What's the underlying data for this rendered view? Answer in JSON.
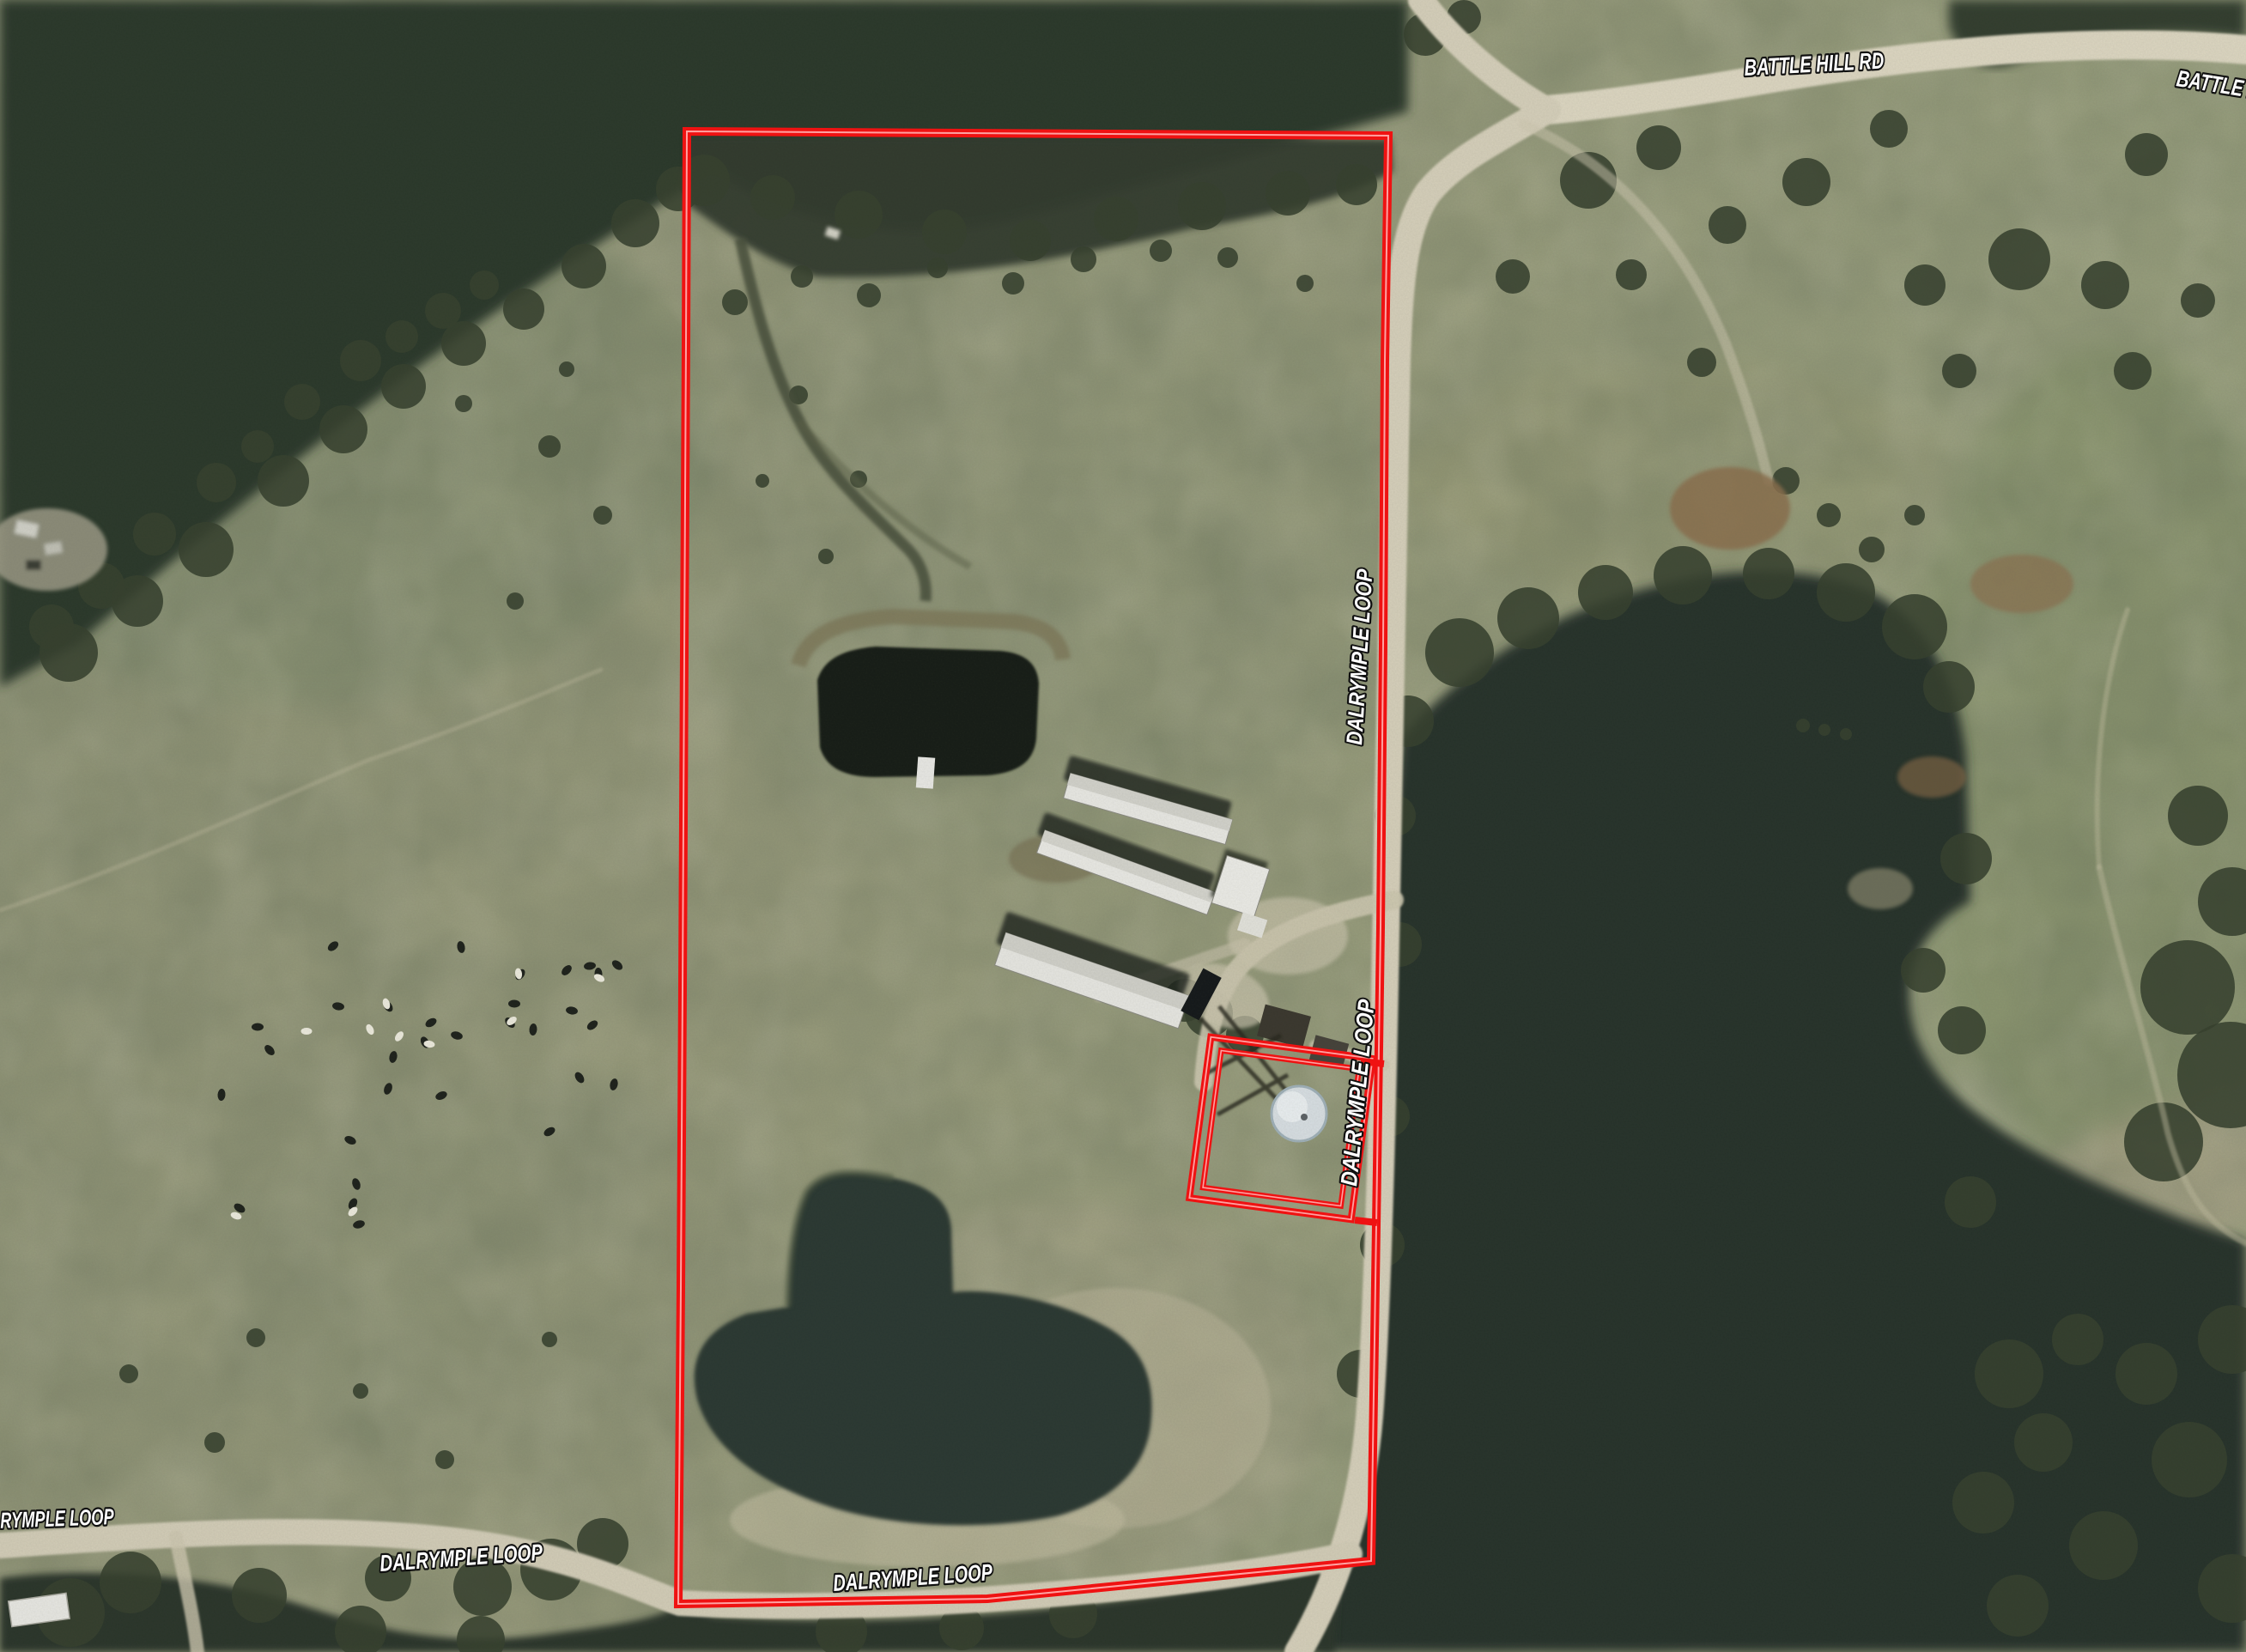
{
  "map": {
    "boundary": {
      "color": "#ef1212",
      "inner_line_color": "#ffa2a2"
    },
    "label_style": {
      "fill": "#ffffff",
      "outline": "#101010"
    },
    "palette": {
      "tree": "#35402e",
      "cattle_dark": "#1d211b",
      "cattle_light": "#ebe9dc"
    },
    "road_labels": {
      "battle_hill_top": "BATTLE HILL RD",
      "battle_hill_right_clipped": "BATTLE HILL RD",
      "dalrymple_east_upper": "DALRYMPLE LOOP",
      "dalrymple_east_lower": "DALRYMPLE LOOP",
      "dalrymple_south_far_left_clipped": "DALRYMPLE LOOP",
      "dalrymple_south_west": "DALRYMPLE LOOP",
      "dalrymple_south_center": "DALRYMPLE LOOP"
    },
    "trees": [
      [
        420,
        420,
        24
      ],
      [
        468,
        392,
        19
      ],
      [
        516,
        362,
        21
      ],
      [
        564,
        332,
        17
      ],
      [
        352,
        468,
        21
      ],
      [
        300,
        520,
        19
      ],
      [
        252,
        562,
        23
      ],
      [
        180,
        622,
        25
      ],
      [
        118,
        682,
        27
      ],
      [
        60,
        730,
        26
      ],
      [
        640,
        520,
        13
      ],
      [
        702,
        600,
        11
      ],
      [
        600,
        700,
        10
      ],
      [
        540,
        470,
        10
      ],
      [
        660,
        430,
        9
      ],
      [
        298,
        1558,
        11
      ],
      [
        420,
        1620,
        9
      ],
      [
        518,
        1700,
        11
      ],
      [
        250,
        1680,
        12
      ],
      [
        150,
        1600,
        11
      ],
      [
        640,
        1560,
        9
      ],
      [
        856,
        352,
        15
      ],
      [
        934,
        322,
        13
      ],
      [
        1012,
        344,
        14
      ],
      [
        1092,
        312,
        12
      ],
      [
        1180,
        330,
        13
      ],
      [
        1262,
        302,
        15
      ],
      [
        1352,
        292,
        13
      ],
      [
        930,
        460,
        11
      ],
      [
        1000,
        558,
        10
      ],
      [
        962,
        648,
        9
      ],
      [
        888,
        560,
        8
      ],
      [
        1430,
        300,
        12
      ],
      [
        1520,
        330,
        10
      ],
      [
        820,
        210,
        30
      ],
      [
        900,
        230,
        26
      ],
      [
        1000,
        250,
        28
      ],
      [
        1100,
        270,
        26
      ],
      [
        1200,
        280,
        24
      ],
      [
        1300,
        255,
        26
      ],
      [
        1400,
        240,
        28
      ],
      [
        1500,
        225,
        26
      ],
      [
        1580,
        215,
        24
      ],
      [
        80,
        760,
        34
      ],
      [
        160,
        700,
        30
      ],
      [
        240,
        640,
        32
      ],
      [
        330,
        560,
        30
      ],
      [
        400,
        500,
        28
      ],
      [
        470,
        450,
        26
      ],
      [
        540,
        400,
        26
      ],
      [
        610,
        360,
        24
      ],
      [
        680,
        310,
        26
      ],
      [
        740,
        260,
        28
      ],
      [
        790,
        220,
        26
      ],
      [
        1850,
        210,
        33
      ],
      [
        1932,
        172,
        26
      ],
      [
        2012,
        262,
        22
      ],
      [
        1762,
        322,
        20
      ],
      [
        2104,
        212,
        28
      ],
      [
        2242,
        332,
        24
      ],
      [
        2352,
        302,
        36
      ],
      [
        2282,
        432,
        20
      ],
      [
        1982,
        422,
        17
      ],
      [
        2452,
        332,
        28
      ],
      [
        2484,
        432,
        22
      ],
      [
        2560,
        350,
        20
      ],
      [
        2200,
        150,
        22
      ],
      [
        1900,
        320,
        18
      ],
      [
        2500,
        180,
        25
      ],
      [
        2100,
        845,
        8
      ],
      [
        2125,
        850,
        7
      ],
      [
        2150,
        855,
        7
      ],
      [
        2080,
        560,
        16
      ],
      [
        2130,
        600,
        14
      ],
      [
        2180,
        640,
        15
      ],
      [
        2230,
        600,
        12
      ],
      [
        2548,
        1150,
        55
      ],
      [
        2598,
        1252,
        62
      ],
      [
        2520,
        1330,
        46
      ],
      [
        2600,
        1050,
        40
      ],
      [
        2560,
        950,
        35
      ],
      [
        642,
        1828,
        36
      ],
      [
        702,
        1798,
        30
      ],
      [
        562,
        1848,
        34
      ],
      [
        452,
        1838,
        27
      ],
      [
        302,
        1858,
        32
      ],
      [
        152,
        1843,
        36
      ],
      [
        82,
        1878,
        40
      ],
      [
        980,
        1900,
        30
      ],
      [
        1120,
        1896,
        26
      ],
      [
        1250,
        1880,
        28
      ],
      [
        420,
        1900,
        30
      ],
      [
        560,
        1910,
        28
      ],
      [
        1660,
        40,
        25
      ],
      [
        1705,
        20,
        20
      ],
      [
        1700,
        760,
        40
      ],
      [
        1780,
        720,
        36
      ],
      [
        1870,
        690,
        32
      ],
      [
        1960,
        670,
        34
      ],
      [
        2060,
        668,
        30
      ],
      [
        2150,
        690,
        34
      ],
      [
        2230,
        730,
        38
      ],
      [
        2270,
        800,
        30
      ],
      [
        1640,
        840,
        30
      ],
      [
        1625,
        950,
        24
      ],
      [
        1630,
        1100,
        26
      ],
      [
        1618,
        1300,
        24
      ],
      [
        1610,
        1450,
        26
      ],
      [
        1585,
        1600,
        28
      ],
      [
        2290,
        1000,
        30
      ],
      [
        2285,
        1200,
        28
      ],
      [
        2240,
        1130,
        26
      ],
      [
        2295,
        1400,
        30
      ],
      [
        2340,
        1600,
        40
      ],
      [
        2310,
        1750,
        36
      ],
      [
        2420,
        1560,
        30
      ],
      [
        2380,
        1680,
        34
      ],
      [
        2500,
        1600,
        36
      ],
      [
        2600,
        1560,
        40
      ],
      [
        2550,
        1700,
        44
      ],
      [
        2450,
        1800,
        40
      ],
      [
        2600,
        1850,
        40
      ],
      [
        2350,
        1870,
        36
      ],
      [
        1408,
        1180,
        28
      ],
      [
        1450,
        1205,
        22
      ],
      [
        1380,
        1165,
        25
      ]
    ],
    "cattle": {
      "dark": [
        [
          300,
          1196
        ],
        [
          314,
          1223
        ],
        [
          258,
          1275
        ],
        [
          388,
          1102
        ],
        [
          394,
          1172
        ],
        [
          452,
          1172
        ],
        [
          458,
          1231
        ],
        [
          502,
          1191
        ],
        [
          532,
          1206
        ],
        [
          495,
          1214
        ],
        [
          452,
          1268
        ],
        [
          514,
          1276
        ],
        [
          408,
          1328
        ],
        [
          415,
          1379
        ],
        [
          411,
          1402
        ],
        [
          418,
          1426
        ],
        [
          279,
          1407
        ],
        [
          537,
          1103
        ],
        [
          606,
          1135
        ],
        [
          687,
          1125
        ],
        [
          719,
          1124
        ],
        [
          697,
          1134
        ],
        [
          660,
          1130
        ],
        [
          599,
          1169
        ],
        [
          594,
          1191
        ],
        [
          621,
          1199
        ],
        [
          690,
          1194
        ],
        [
          666,
          1177
        ],
        [
          675,
          1255
        ],
        [
          715,
          1263
        ],
        [
          640,
          1318
        ]
      ],
      "light": [
        [
          357,
          1201
        ],
        [
          431,
          1199
        ],
        [
          465,
          1207
        ],
        [
          500,
          1216
        ],
        [
          450,
          1169
        ],
        [
          411,
          1411
        ],
        [
          275,
          1416
        ],
        [
          604,
          1134
        ],
        [
          596,
          1189
        ],
        [
          698,
          1139
        ]
      ]
    }
  }
}
